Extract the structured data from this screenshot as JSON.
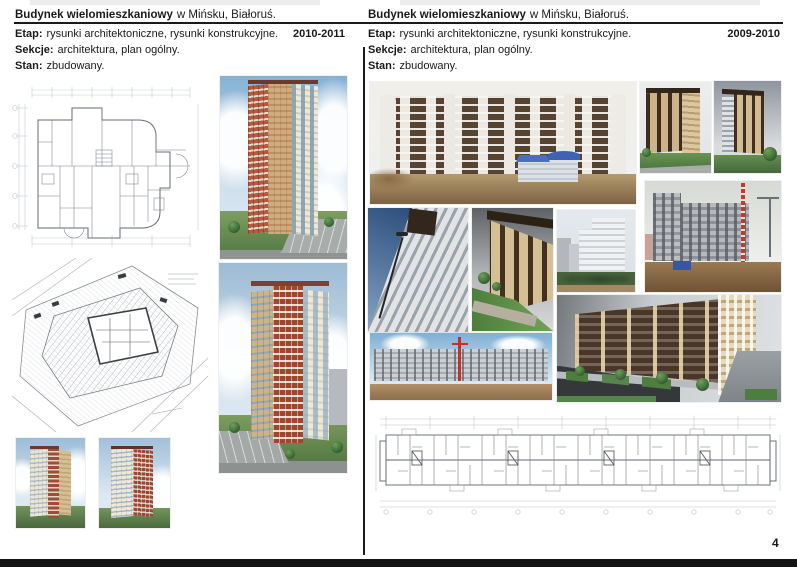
{
  "page": {
    "number": "4",
    "footer_bar_color": "#141414",
    "divider_color": "#1a1a1a",
    "background": "#ffffff"
  },
  "columns": {
    "left": {
      "title_bold": "Budynek wielomieszkaniowy",
      "title_rest": "w Mińsku, Białoruś.",
      "etap_label": "Etap:",
      "etap_text": "rysunki architektoniczne, rysunki konstrukcyjne.",
      "years": "2010-2011",
      "sekcje_label": "Sekcje:",
      "sekcje_text": "architektura, plan ogólny.",
      "stan_label": "Stan:",
      "stan_text": "zbudowany."
    },
    "right": {
      "title_bold": "Budynek wielomieszkaniowy",
      "title_rest": "w Mińsku, Białoruś.",
      "etap_label": "Etap:",
      "etap_text": "rysunki architektoniczne, rysunki konstrukcyjne.",
      "years": "2009-2010",
      "sekcje_label": "Sekcje:",
      "sekcje_text": "architektura, plan ogólny.",
      "stan_label": "Stan:",
      "stan_text": "zbudowany."
    }
  }
}
